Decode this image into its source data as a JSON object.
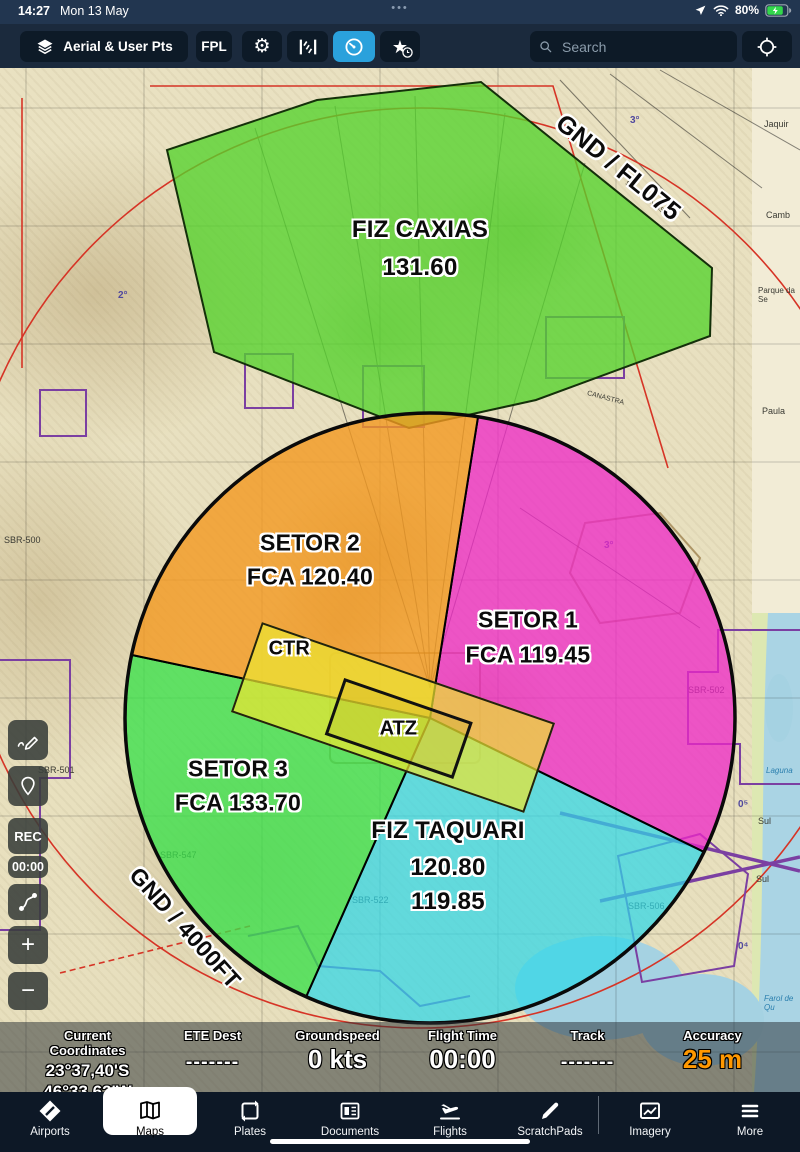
{
  "status_bar": {
    "time": "14:27",
    "date": "Mon 13 May",
    "overflow_dots": "•••",
    "battery_percent": "80%"
  },
  "toolbar": {
    "layers_button": "Aerial & User Pts",
    "fpl_button": "FPL",
    "search_placeholder": "Search"
  },
  "map": {
    "airspaces": {
      "fiz_caxias_name": "FIZ CAXIAS",
      "fiz_caxias_freq": "131.60",
      "fiz_caxias_limits": "GND / FL075",
      "setor2_name": "SETOR 2",
      "setor2_freq": "FCA 120.40",
      "setor1_name": "SETOR 1",
      "setor1_freq": "FCA 119.45",
      "setor3_name": "SETOR 3",
      "setor3_freq": "FCA 133.70",
      "fiz_taquari_name": "FIZ TAQUARI",
      "fiz_taquari_freq1": "120.80",
      "fiz_taquari_freq2": "119.85",
      "fca_limits": "GND / 4000FT",
      "ctr": "CTR",
      "atz": "ATZ"
    },
    "chart_labels": [
      "SBR-500",
      "SBR-501",
      "SBR-502",
      "SBR-506",
      "SBR-522",
      "SBR-547",
      "Jaquir",
      "Camb",
      "Parque da Se",
      "Paula",
      "Sul",
      "Sul",
      "Laguna",
      "Farol de Qu",
      "SÃO FRANCISCO",
      "CANASTRA",
      "2°",
      "3°",
      "3°",
      "0⁵",
      "0⁴"
    ],
    "colors": {
      "fiz_green": "#55d22e",
      "sector_orange": "#f29820",
      "sector_magenta": "#ee28c6",
      "sector_green": "#3ae04a",
      "sector_cyan": "#2fd7e8",
      "ctr_yellow": "#ebe432",
      "accent_blue": "#2aa1dc",
      "accuracy_orange": "#ff9800"
    }
  },
  "side_controls": {
    "rec_label": "REC",
    "timer_value": "00:00",
    "zoom_in": "+",
    "zoom_out": "−"
  },
  "info_bar": {
    "items": [
      {
        "label": "Current Coordinates",
        "line1": "23°37,40'S",
        "line2": "46°33,62'W"
      },
      {
        "label": "ETE Dest",
        "value": "-------"
      },
      {
        "label": "Groundspeed",
        "value": "0 kts"
      },
      {
        "label": "Flight Time",
        "value": "00:00"
      },
      {
        "label": "Track",
        "value": "-------"
      },
      {
        "label": "Accuracy",
        "value": "25 m"
      }
    ]
  },
  "tab_bar": {
    "active_tab": "Maps",
    "tabs": [
      "Airports",
      "Maps",
      "Plates",
      "Documents",
      "Flights",
      "ScratchPads",
      "Imagery",
      "More"
    ]
  }
}
